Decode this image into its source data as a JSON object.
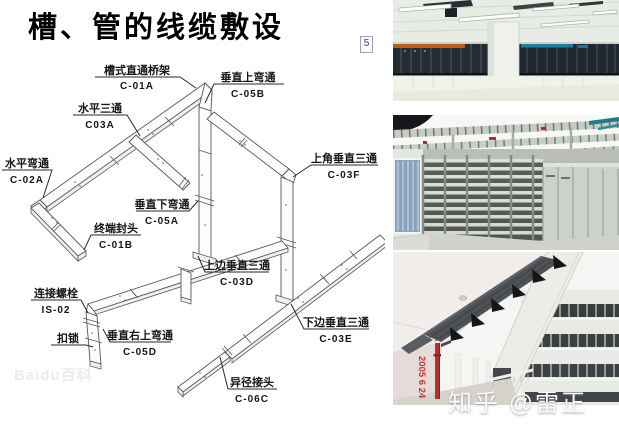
{
  "title": "槽、管的线缆敷设",
  "page_marker": "5",
  "diagram": {
    "watermark": "Baidu百科",
    "labels": [
      {
        "name": "槽式直通桥架",
        "code": "C-01A"
      },
      {
        "name": "垂直上弯通",
        "code": "C-05B"
      },
      {
        "name": "水平三通",
        "code": "C03A"
      },
      {
        "name": "水平弯通",
        "code": "C-02A"
      },
      {
        "name": "垂直下弯通",
        "code": "C-05A"
      },
      {
        "name": "终端封头",
        "code": "C-01B"
      },
      {
        "name": "上角垂直三通",
        "code": "C-03F"
      },
      {
        "name": "上边垂直三通",
        "code": "C-03D"
      },
      {
        "name": "连接螺栓",
        "code": "IS-02"
      },
      {
        "name": "扣锁",
        "code": ""
      },
      {
        "name": "垂直右上弯通",
        "code": "C-05D"
      },
      {
        "name": "下边垂直三通",
        "code": "C-03E"
      },
      {
        "name": "异径接头",
        "code": "C-06C"
      }
    ]
  },
  "photos": {
    "photo3_date_stamp": "2005 6 24"
  },
  "footer_watermark": "知乎 @雷正",
  "colors": {
    "date_stamp_red": "#cc3333",
    "rack_stripe_orange": "#bf5a1e",
    "curtain_blue": "#8aa2bd",
    "cable_tray_dark": "#4e5155",
    "cable_bundle_teal": "#1b7f9e"
  }
}
